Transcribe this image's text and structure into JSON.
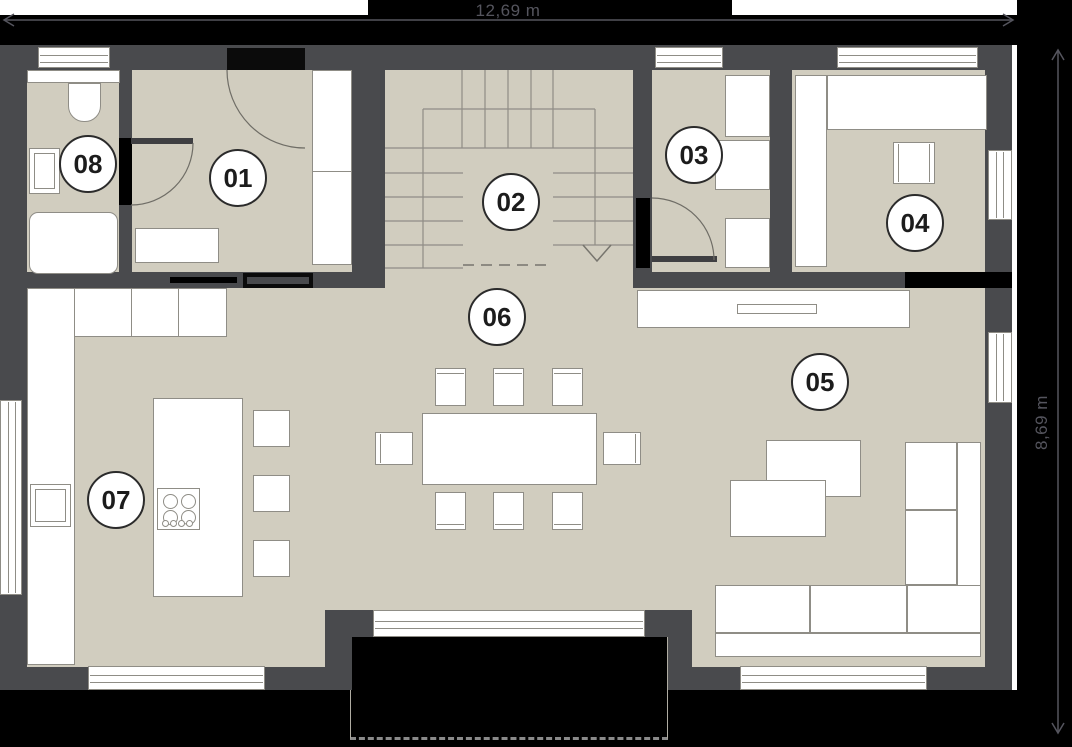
{
  "plan": {
    "width_label": "12,69 m",
    "height_label": "8,69 m",
    "rooms": [
      {
        "id": "01"
      },
      {
        "id": "02"
      },
      {
        "id": "03"
      },
      {
        "id": "04"
      },
      {
        "id": "05"
      },
      {
        "id": "06"
      },
      {
        "id": "07"
      },
      {
        "id": "08"
      }
    ],
    "colors": {
      "floor": "#d1cdbf",
      "wall": "#494a4d",
      "exterior": "#000000",
      "furniture_outline": "#8f8d86",
      "dimension_text": "#55555e"
    }
  }
}
